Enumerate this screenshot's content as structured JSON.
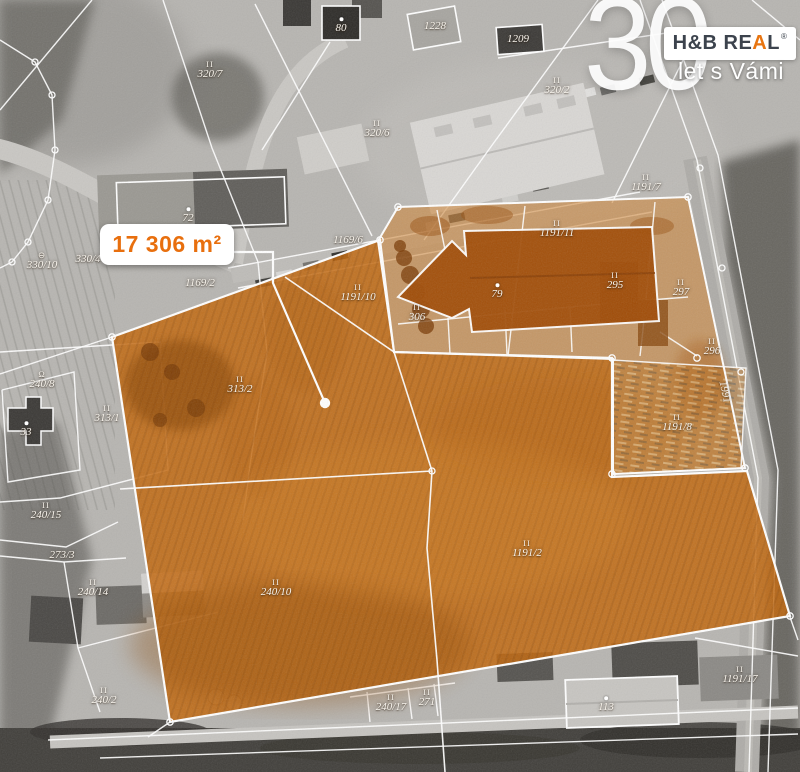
{
  "branding": {
    "anniversary_number": "30",
    "logo": {
      "pre": "H&B RE",
      "accent_letter": "A",
      "post": "L",
      "registered": "®"
    },
    "tagline": "let s Vámi",
    "accent_color": "#e87511"
  },
  "area_callout": {
    "text": "17 306 m²"
  },
  "map": {
    "highlight_color": "#c2660a",
    "yard_highlight_color": "#cd8436",
    "parcel_line_color": "#ffffff",
    "parcel_labels": [
      {
        "text": "320/7",
        "mark": "II",
        "x": 210,
        "y": 70
      },
      {
        "text": "80",
        "mark": "",
        "x": 341,
        "y": 26,
        "dot": true
      },
      {
        "text": "1228",
        "mark": "",
        "x": 435,
        "y": 27
      },
      {
        "text": "1209",
        "mark": "",
        "x": 518,
        "y": 40
      },
      {
        "text": "320/2",
        "mark": "II",
        "x": 557,
        "y": 86
      },
      {
        "text": "320/6",
        "mark": "II",
        "x": 377,
        "y": 129
      },
      {
        "text": "1191/7",
        "mark": "II",
        "x": 646,
        "y": 183
      },
      {
        "text": "330/10",
        "mark": "⊖",
        "x": 42,
        "y": 261
      },
      {
        "text": "330/4",
        "mark": "",
        "x": 88,
        "y": 260
      },
      {
        "text": "1169/2",
        "mark": "",
        "x": 200,
        "y": 284
      },
      {
        "text": "1169/6",
        "mark": "",
        "x": 348,
        "y": 241
      },
      {
        "text": "72",
        "mark": "",
        "x": 188,
        "y": 216,
        "dot": true
      },
      {
        "text": "1191/11",
        "mark": "II",
        "x": 557,
        "y": 229
      },
      {
        "text": "1191/10",
        "mark": "II",
        "x": 358,
        "y": 293
      },
      {
        "text": "306",
        "mark": "II",
        "x": 417,
        "y": 313
      },
      {
        "text": "79",
        "mark": "",
        "x": 497,
        "y": 292,
        "dot": true
      },
      {
        "text": "295",
        "mark": "II",
        "x": 615,
        "y": 281
      },
      {
        "text": "297",
        "mark": "II",
        "x": 681,
        "y": 288
      },
      {
        "text": "296",
        "mark": "II",
        "x": 712,
        "y": 347
      },
      {
        "text": "1991",
        "mark": "",
        "x": 724,
        "y": 392,
        "rot": 78
      },
      {
        "text": "1191/8",
        "mark": "II",
        "x": 677,
        "y": 423
      },
      {
        "text": "313/1",
        "mark": "II",
        "x": 107,
        "y": 414
      },
      {
        "text": "240/8",
        "mark": "Ω",
        "x": 42,
        "y": 380
      },
      {
        "text": "33",
        "mark": "",
        "x": 26,
        "y": 430,
        "dot": true
      },
      {
        "text": "313/2",
        "mark": "II",
        "x": 240,
        "y": 385
      },
      {
        "text": "240/15",
        "mark": "II",
        "x": 46,
        "y": 511
      },
      {
        "text": "273/3",
        "mark": "",
        "x": 62,
        "y": 556
      },
      {
        "text": "240/14",
        "mark": "II",
        "x": 93,
        "y": 588
      },
      {
        "text": "240/2",
        "mark": "II",
        "x": 104,
        "y": 696
      },
      {
        "text": "240/10",
        "mark": "II",
        "x": 276,
        "y": 588
      },
      {
        "text": "1191/2",
        "mark": "II",
        "x": 527,
        "y": 549
      },
      {
        "text": "240/17",
        "mark": "II",
        "x": 391,
        "y": 703
      },
      {
        "text": "271",
        "mark": "II",
        "x": 427,
        "y": 698
      },
      {
        "text": "113",
        "mark": "",
        "x": 606,
        "y": 705,
        "dot": true
      },
      {
        "text": "1191/17",
        "mark": "II",
        "x": 740,
        "y": 675
      }
    ]
  }
}
